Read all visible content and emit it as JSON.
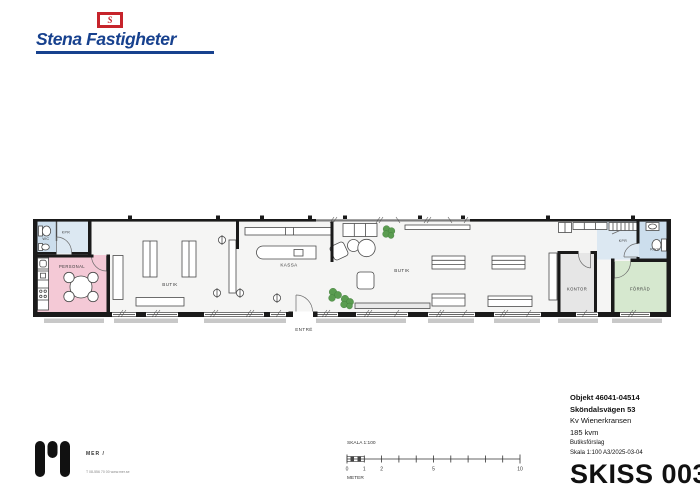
{
  "header": {
    "brand": "Stena Fastigheter",
    "flag_letter": "S"
  },
  "floor_plan": {
    "labels": {
      "wc": "WC",
      "kpr_left": "KPR",
      "personal": "PERSONAL",
      "butik_left": "BUTIK",
      "kassa": "KASSA",
      "butik_right": "BUTIK",
      "entre": "ENTRÉ",
      "kontor": "KONTOR",
      "forrad": "FÖRRÅD",
      "kpr_right": "KPR",
      "rwc": "RWC"
    },
    "colors": {
      "room_pink": "#f4c9d6",
      "room_blue": "#ccdeed",
      "room_blue_light": "#dce8f2",
      "room_green": "#d6e8cf",
      "room_gray": "#e6e6e6",
      "plant_green": "#5a9c50",
      "wall_black": "#1a1a1a"
    }
  },
  "scale_bar": {
    "title": "SKALA 1:100",
    "unit": "METER",
    "ticks": [
      "0",
      "1",
      "2",
      "5",
      "10"
    ]
  },
  "title_block": {
    "line1": "Objekt 46041-04514",
    "line2": "Sköndalsvägen 53",
    "line3": "Kv Wienerkransen",
    "line4": "185 kvm",
    "line5": "Butiksförslag",
    "line6": "Skala 1:100 A3/2025-03-04",
    "sketch": "SKISS 003"
  },
  "footer": {
    "firm": "MER /",
    "contact": "T 08-556 70 00   www.mer.se"
  }
}
